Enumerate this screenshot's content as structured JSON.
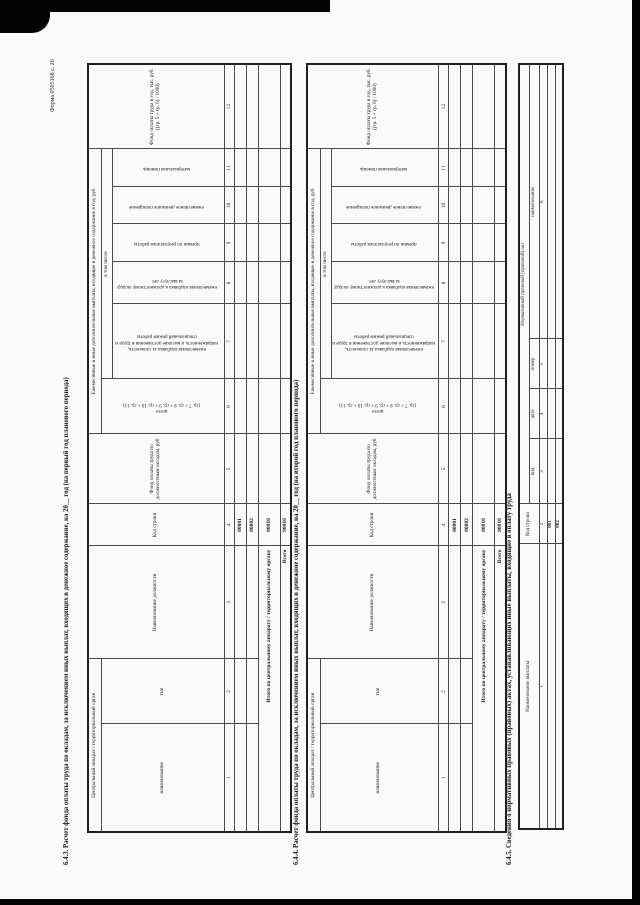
{
  "form_number": "Форма 0505168 с. 26",
  "s643": {
    "title": "6.4.3. Расчет фонда оплаты труда по окладам, за исключением иных выплат, входящих в денежное содержание, на 20__ год (на первый год планового периода)",
    "headers": {
      "org_group": "Центральный аппарат / территориальный орган",
      "name": "наименование",
      "type": "тип",
      "position": "Наименование должности",
      "row_code": "Код строки",
      "salary_fund": "Фонд оплаты труда по должностным окладам, руб",
      "payments_group": "Ежемесячные и иные дополнительные выплаты, входящие в денежное содержание в год, руб",
      "total": "всего",
      "total_formula": "(гр. 7 + гр. 8 + гр. 9 + гр. 10 + гр. 11)",
      "including": "в том числе",
      "complexity": "ежемесячная надбавка за сложность, напряженность и высокие достижения в труде и специальный режим работы",
      "seniority": "ежемесячная надбавка к должностному окладу за выслугу лет",
      "bonus": "премии по результатам работы",
      "incentive": "ежемесячное денежное поощрение",
      "material_aid": "материальная помощь",
      "annual_fund": "Фонд оплаты труда в год, тыс. руб. ((гр. 5 + гр. 6) / 1000)"
    },
    "col_numbers": [
      "1",
      "2",
      "3",
      "4",
      "5",
      "6",
      "7",
      "8",
      "9",
      "10",
      "11",
      "12"
    ],
    "rows": [
      {
        "code": "00001"
      },
      {
        "code": "00002"
      }
    ],
    "total_row": {
      "label": "Итого по центральному аппарату / территориальному органу",
      "code": "00010"
    },
    "grand_total_row": {
      "label": "Всего",
      "code": "90010"
    }
  },
  "s644": {
    "title": "6.4.4. Расчет фонда оплаты труда по окладам, за исключением иных выплат, входящих в денежное содержание, на 20__ год (на второй год планового периода)",
    "headers": {
      "org_group": "Центральный аппарат / территориальный орган",
      "name": "наименование",
      "type": "тип",
      "position": "Наименование должности",
      "row_code": "Код строки",
      "salary_fund": "Фонд оплаты труда по должностным окладам, руб",
      "payments_group": "Ежемесячные и иные дополнительные выплаты, входящие в денежное содержание в год, руб",
      "total": "всего",
      "total_formula": "(гр. 7 + гр. 8 + гр. 9 + гр. 10 + гр. 11)",
      "including": "в том числе",
      "complexity": "ежемесячная надбавка за сложность, напряженность и высокие достижения в труде и специальный режим работы",
      "seniority": "ежемесячная надбавка к должностному окладу за выслугу лет",
      "bonus": "премии по результатам работы",
      "incentive": "ежемесячное денежное поощрение",
      "material_aid": "материальная помощь",
      "annual_fund": "Фонд оплаты труда в год, тыс. руб. ((гр. 5 + гр. 6) / 1000)"
    },
    "col_numbers": [
      "1",
      "2",
      "3",
      "4",
      "5",
      "6",
      "7",
      "8",
      "9",
      "10",
      "11",
      "12"
    ],
    "rows": [
      {
        "code": "00001"
      },
      {
        "code": "00002"
      }
    ],
    "total_row": {
      "label": "Итого по центральному аппарату / территориальному органу",
      "code": "00010"
    },
    "grand_total_row": {
      "label": "Всего",
      "code": "90010"
    }
  },
  "s645": {
    "title": "6.4.5. Сведения о нормативных правовых (правовых) актах, устанавливающих иные выплаты, входящие в оплату труда",
    "headers": {
      "payment_name": "Наименование выплаты",
      "row_code": "Код строки",
      "act_group": "Нормативный правовой (правовой) акт",
      "kind": "вид",
      "date": "дата",
      "number": "номер",
      "act_name": "наименование"
    },
    "col_numbers": [
      "1",
      "2",
      "3",
      "4",
      "5",
      "6"
    ],
    "rows": [
      {
        "code": "001"
      },
      {
        "code": "002"
      }
    ]
  }
}
